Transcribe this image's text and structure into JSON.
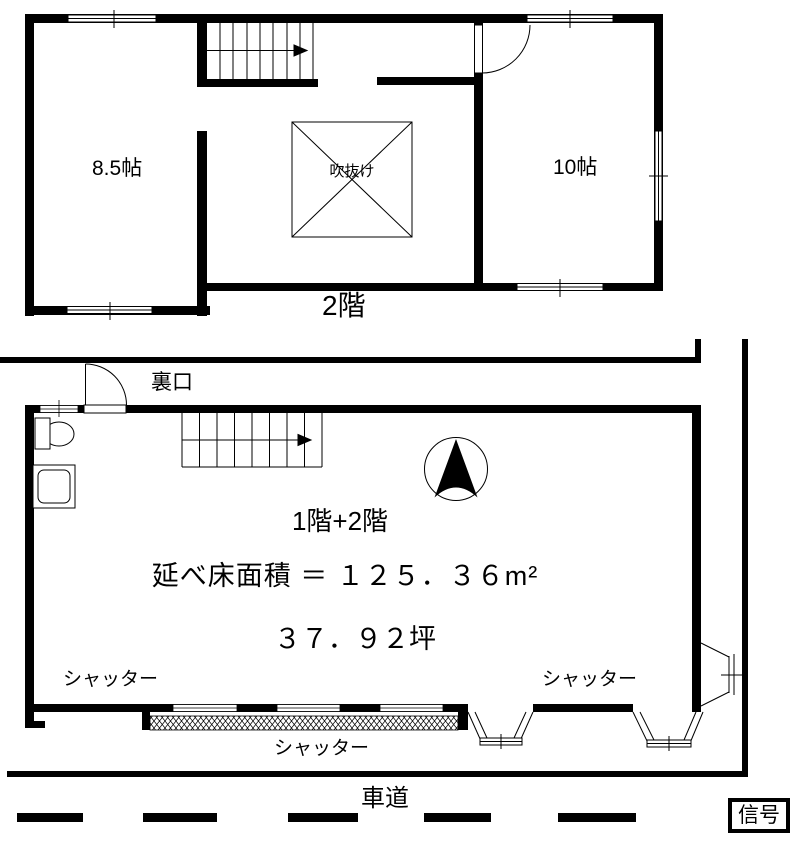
{
  "colors": {
    "line": "#000000",
    "background": "#ffffff"
  },
  "floor2": {
    "label": "2階",
    "room_left_size": "8.5帖",
    "room_right_size": "10帖",
    "void_label": "吹抜け"
  },
  "floor1": {
    "back_entrance_label": "裏口",
    "floors_label": "1階+2階",
    "total_floor_area_line": "延べ床面積 ＝ １２５．３６m²",
    "tsubo_area_line": "３７．９２坪",
    "shutter_left_label": "シャッター",
    "shutter_right_label": "シャッター",
    "shutter_bottom_label": "シャッター"
  },
  "road": {
    "label": "車道",
    "signal_label": "信号"
  }
}
